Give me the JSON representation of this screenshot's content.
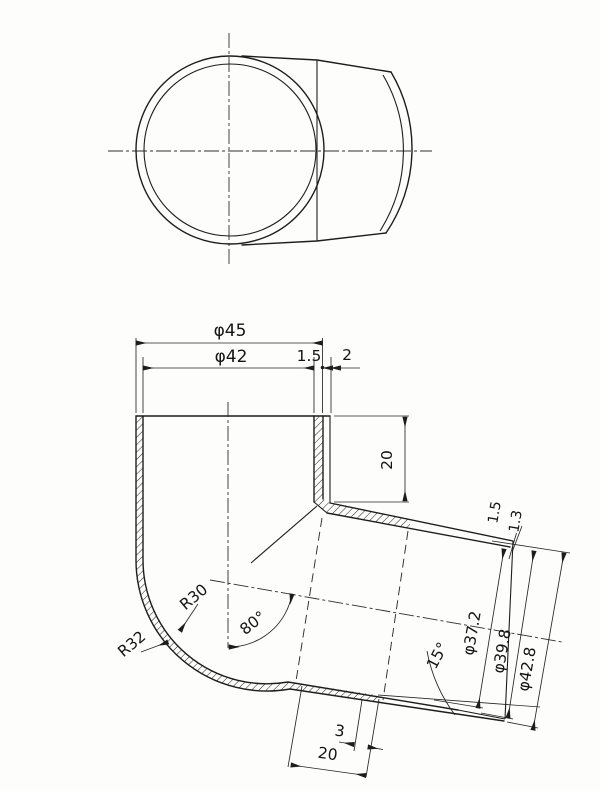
{
  "drawing": {
    "title": "pipe-elbow-fitting-drawing",
    "background_color": "#fdfdfc",
    "line_color": "#1d1d1d",
    "views": {
      "top_view": "fitting seen from above: two concentric circles with socket body at right",
      "section_view": "sectioned 80-degree elbow with hatched walls"
    },
    "dimensions": {
      "top_outer_diameter": "φ45",
      "top_inner_diameter": "φ42",
      "top_wall_thickness": "1.5",
      "top_step": "2",
      "socket_depth": "20",
      "bend_inner_radius": "R30",
      "bend_outer_radius": "R32",
      "bend_angle": "80°",
      "tip_taper_angle": "15°",
      "branch_bore_diameter": "φ37.2",
      "branch_mid_diameter": "φ39.8",
      "branch_outer_diameter": "φ42.8",
      "branch_wall_thickness": "1.5",
      "branch_tip_thickness": "1.3",
      "tip_chamfer_length": "3",
      "tip_section_length": "20"
    }
  }
}
